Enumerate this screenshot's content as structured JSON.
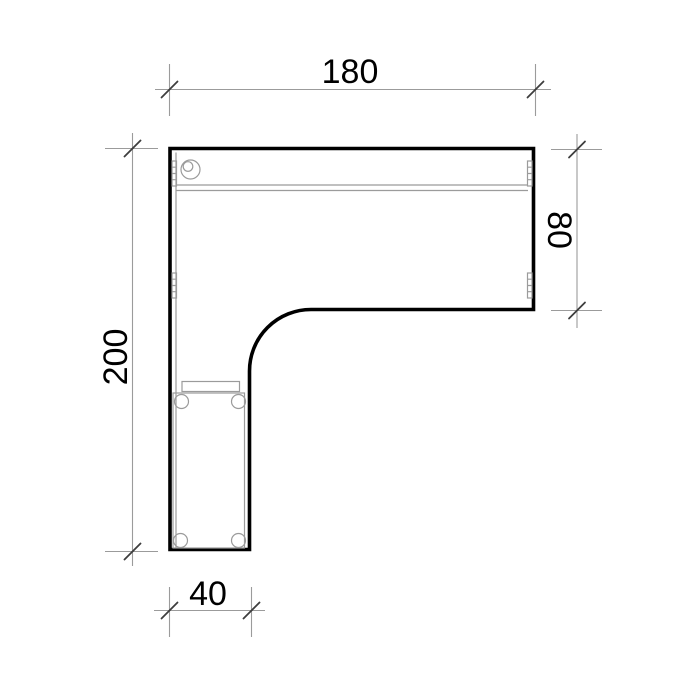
{
  "drawing": {
    "name": "l-shaped-desk-plan-view",
    "dimensions": {
      "top": {
        "label": "180",
        "value": 180
      },
      "right": {
        "label": "80",
        "value": 80
      },
      "left": {
        "label": "200",
        "value": 200
      },
      "bottom": {
        "label": "40",
        "value": 40
      }
    },
    "colors": {
      "background": "#ffffff",
      "outline": "#000000",
      "detail_lines": "#9b9b9b",
      "dimension_lines": "#9b9b9b",
      "tick_marks": "#3d3d3d",
      "text": "#000000"
    }
  }
}
